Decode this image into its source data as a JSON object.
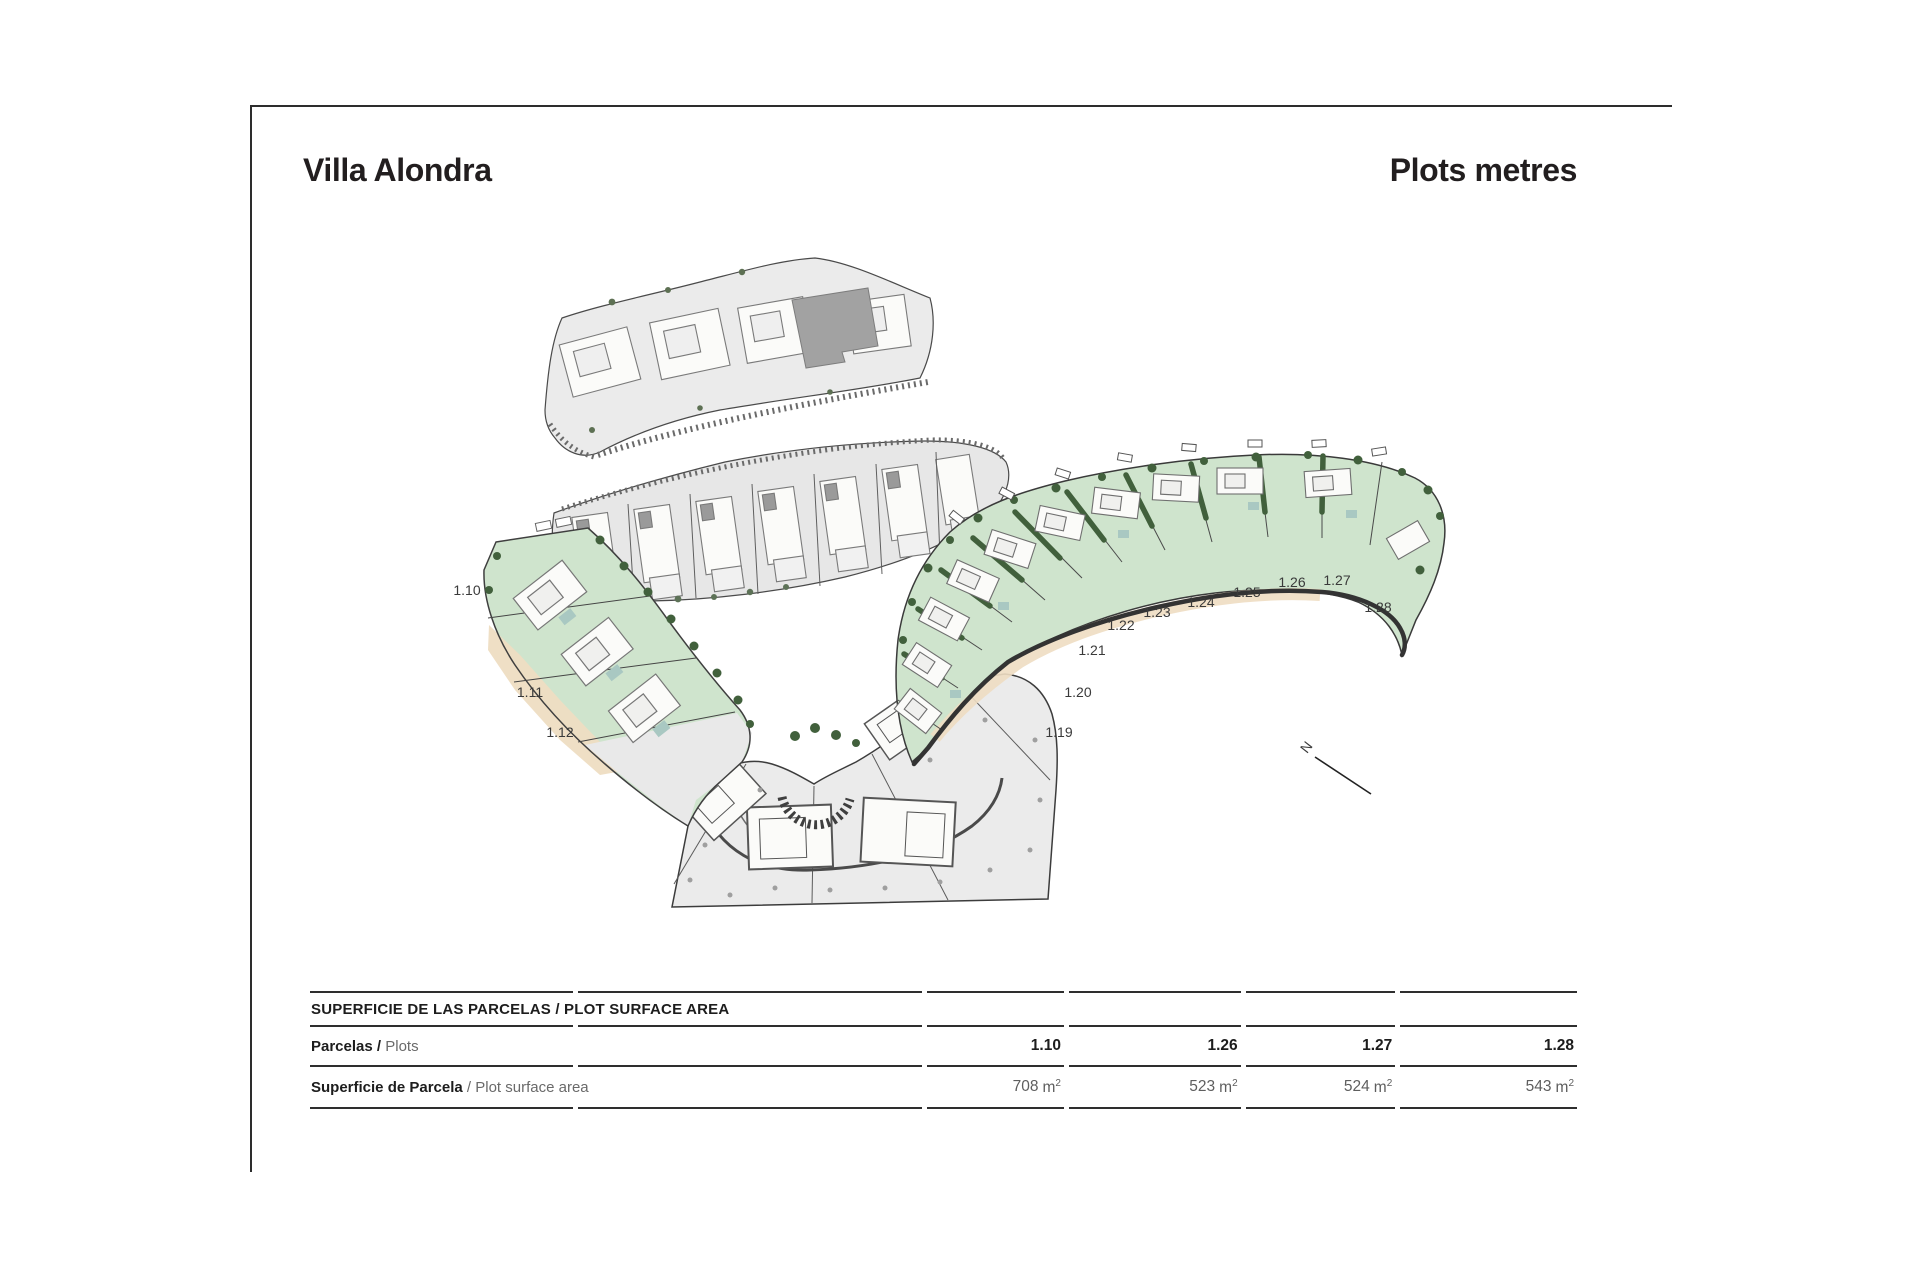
{
  "page": {
    "title_left": "Villa Alondra",
    "title_right": "Plots metres"
  },
  "plan": {
    "labels": [
      "1.10",
      "1.11",
      "1.12",
      "1.19",
      "1.20",
      "1.21",
      "1.22",
      "1.23",
      "1.24",
      "1.25",
      "1.26",
      "1.27",
      "1.28"
    ],
    "north": "N"
  },
  "colors": {
    "plot_green": "#cfe4cd",
    "vegetation_green": "#41603c",
    "sand_tan": "#eeddc2",
    "pavement_gray": "#ebebeb",
    "pavement_gray_mid": "#e7e7e7",
    "building_white": "#fbfbf9",
    "roof_dark_gray": "#a2a2a2",
    "pool_teal": "#a9c8c2",
    "line_dark": "#3a3a3a"
  },
  "table": {
    "header": "SUPERFICIE DE LAS PARCELAS / PLOT SURFACE AREA",
    "rows": {
      "plots": {
        "label_bold": "Parcelas /",
        "label_regular": "Plots",
        "values": [
          "1.10",
          "1.26",
          "1.27",
          "1.28"
        ]
      },
      "surface": {
        "label_bold": "Superficie de Parcela",
        "label_regular": "/ Plot surface area",
        "values": [
          "708",
          "523",
          "524",
          "543"
        ],
        "unit": "m",
        "unit_exp": "2"
      }
    }
  }
}
